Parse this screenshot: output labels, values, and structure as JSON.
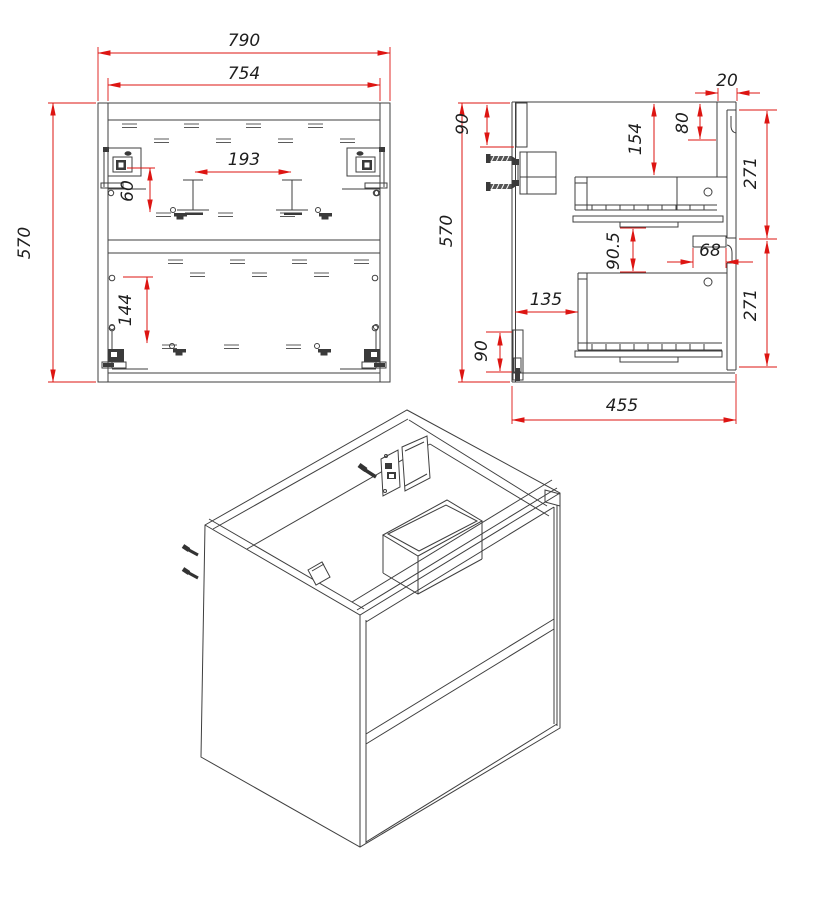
{
  "title": "Two-drawer wall-hung cabinet technical drawing",
  "colors": {
    "line": "#3f3f3f",
    "dimension": "#dd1512",
    "text": "#1e1e1e",
    "background": "#ffffff"
  },
  "views": {
    "front": {
      "label": "front-view",
      "dimensions": {
        "overall_width": "790",
        "carcass_inner_width": "754",
        "overall_height": "570",
        "center_cutout_width": "193",
        "top_slide_offset": "60",
        "bottom_slide_offset": "144"
      }
    },
    "side": {
      "label": "side-view",
      "dimensions": {
        "hanging_rail_height_top": "90",
        "front_overhang": "20",
        "top_recess_depth": "154",
        "front_top_gap": "80",
        "top_drawer_front_height": "271",
        "mid_clearance": "90.5",
        "gap_bracket_width": "68",
        "back_clearance": "135",
        "bottom_drawer_front_height": "271",
        "hanging_rail_height_bottom": "90",
        "overall_height": "570",
        "overall_depth": "455"
      }
    },
    "isometric": {
      "label": "isometric-view"
    }
  }
}
